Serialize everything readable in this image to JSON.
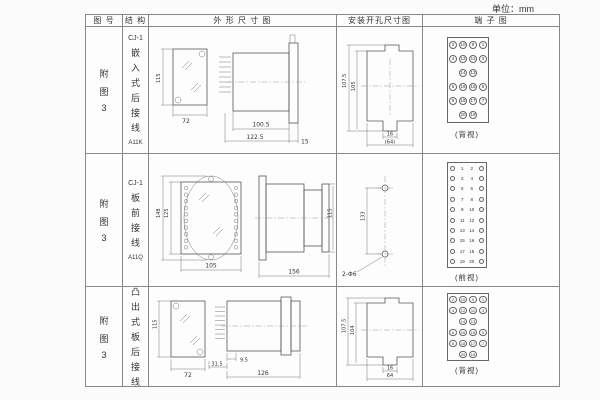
{
  "unit_label": "单位：mm",
  "headers": {
    "fig": "图 号",
    "struct": "结 构",
    "outline": "外 形 尺 寸 图",
    "mount": "安装开孔尺寸图",
    "terminal": "端 子 图"
  },
  "rows": [
    {
      "fig": [
        "附",
        "图",
        "3"
      ],
      "struct_top": "CJ-1",
      "struct_chars": [
        "嵌",
        "入",
        "式",
        "后",
        "接",
        "线"
      ],
      "struct_code": "A11K",
      "outline": {
        "front_h": "115",
        "front_w": "72",
        "depth": "100.5",
        "total": "122.5",
        "flange": "15"
      },
      "mount": {
        "outer_h": "107.5",
        "inner_h": "105",
        "tab_w": "16",
        "total_w": "(64)"
      },
      "terminal": {
        "caption": "(背视)",
        "grid": [
          [
            "2",
            "10",
            "9",
            "1"
          ],
          [
            "4",
            "12",
            "11",
            "3"
          ],
          [
            "",
            "14",
            "13",
            ""
          ],
          [
            "6",
            "16",
            "15",
            "5"
          ],
          [
            "8",
            "18",
            "17",
            "7"
          ],
          [
            "",
            "20",
            "19",
            ""
          ]
        ]
      }
    },
    {
      "fig": [
        "附",
        "图",
        "3"
      ],
      "struct_top": "CJ-1",
      "struct_chars": [
        "板",
        "前",
        "接",
        "线"
      ],
      "struct_code": "A11Q",
      "outline": {
        "front_h_outer": "148",
        "front_h_inner": "125",
        "front_w": "105",
        "side_len": "156",
        "side_h": "115"
      },
      "mount": {
        "pitch": "133",
        "hole_label": "2-Φ6"
      },
      "terminal": {
        "caption": "(前视)",
        "left": [
          "1",
          "3",
          "5",
          "7",
          "9",
          "11",
          "13",
          "15",
          "17",
          "19"
        ],
        "right": [
          "2",
          "4",
          "6",
          "8",
          "10",
          "12",
          "14",
          "16",
          "18",
          "20"
        ]
      }
    },
    {
      "fig": [
        "附",
        "图",
        "3"
      ],
      "struct_top": "CJ-1",
      "struct_chars": [
        "凸",
        "出",
        "式",
        "板",
        "后",
        "接",
        "线"
      ],
      "struct_code": "A11H",
      "outline": {
        "front_h": "115",
        "front_w": "72",
        "pin_d": "31.5",
        "offset": "9.5",
        "total": "126"
      },
      "mount": {
        "outer_h": "107.5",
        "inner_h": "104",
        "tab_w": "16",
        "total_w": "64"
      },
      "terminal": {
        "caption": "(背视)",
        "grid": [
          [
            "2",
            "10",
            "9",
            "1"
          ],
          [
            "4",
            "12",
            "11",
            "3"
          ],
          [
            "",
            "14",
            "13",
            ""
          ],
          [
            "6",
            "16",
            "15",
            "5"
          ],
          [
            "8",
            "18",
            "17",
            "7"
          ],
          [
            "",
            "20",
            "19",
            ""
          ]
        ]
      }
    }
  ]
}
